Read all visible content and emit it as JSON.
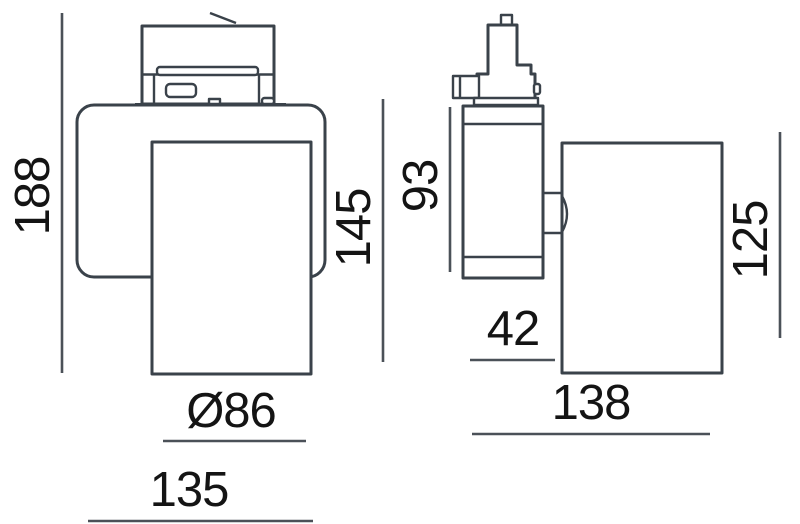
{
  "figure": {
    "kind": "technical-dimension-drawing",
    "views": [
      "front",
      "side"
    ]
  },
  "colors": {
    "outline": "#3a424a",
    "dimension_line": "#4b5158",
    "text": "#141414",
    "background": "#ffffff"
  },
  "dimensions": {
    "front": {
      "overall_height": "188",
      "body_height": "145",
      "diameter": "Ø86",
      "width": "135"
    },
    "side": {
      "adapter_body_height": "93",
      "head_height": "125",
      "body_depth": "42",
      "head_depth": "138"
    }
  }
}
